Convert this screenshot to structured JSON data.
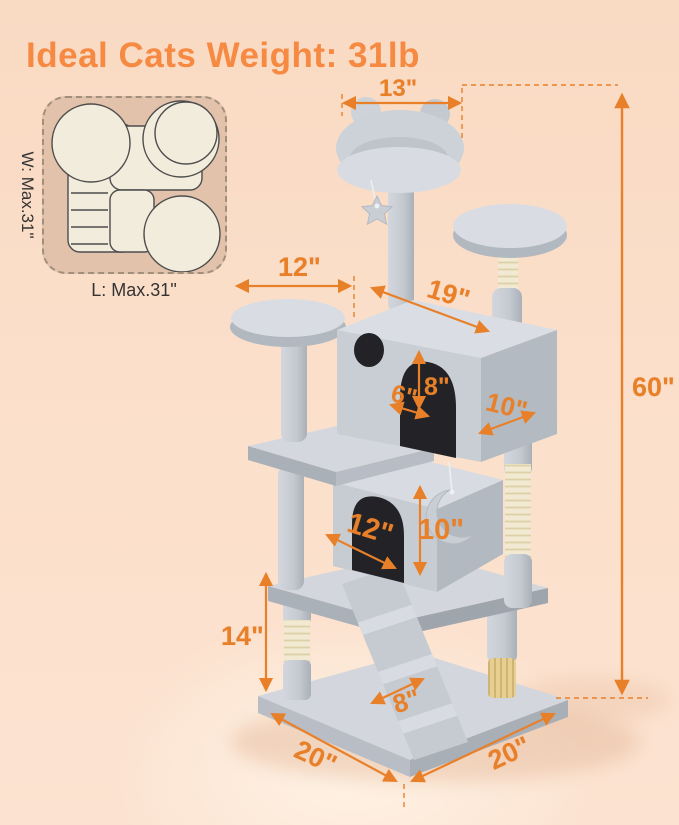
{
  "title": "Ideal Cats Weight: 31lb",
  "inset": {
    "width_label": "W: Max.31\"",
    "length_label": "L: Max.31\""
  },
  "dims": {
    "top_perch_width": "13\"",
    "total_height": "60\"",
    "left_perch_width": "12\"",
    "big_condo_width": "19\"",
    "big_condo_door_width": "6\"",
    "big_condo_door_height": "8\"",
    "big_condo_depth": "10\"",
    "lower_condo_depth": "12\"",
    "lower_condo_height": "10\"",
    "bottom_post_height": "14\"",
    "ramp_width": "8\"",
    "base_edge_left": "20\"",
    "base_edge_right": "20\""
  },
  "icons": {
    "star_toy": "star-shape hanging ball toy",
    "moon_toy": "crescent-shape hanging toy"
  },
  "colors": {
    "accent_orange": "#E8802A",
    "title_orange": "#F68A43",
    "background_peach": "#FBDFCA",
    "tree_gray": "#C9CED5",
    "sisal_cream": "#F1E9D2",
    "inset_tan": "#E2C2AB",
    "label_dark": "#333333"
  }
}
